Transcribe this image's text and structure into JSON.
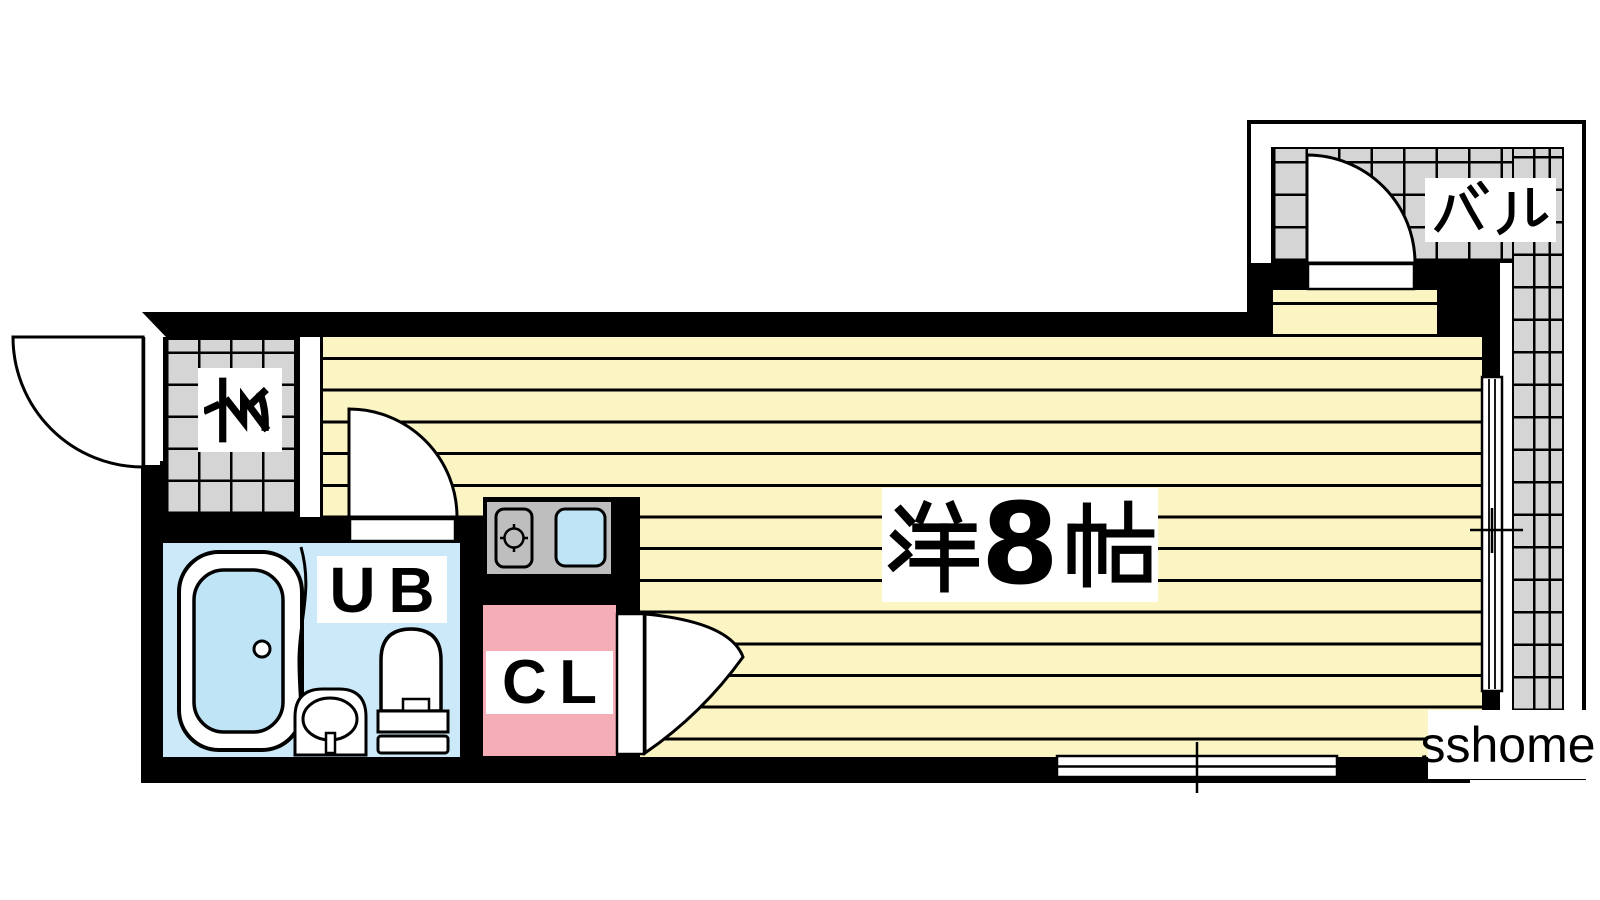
{
  "rooms": {
    "entrance": {
      "label": "玄"
    },
    "main_room": {
      "label": "洋8帖"
    },
    "unit_bath": {
      "label": "UB"
    },
    "closet": {
      "label": "CL"
    },
    "balcony": {
      "label": "バル"
    }
  },
  "watermark": "sshome",
  "colors": {
    "wall": "#000000",
    "room_floor": "#FBF5C4",
    "tile_floor": "#D5D5D5",
    "bath_floor": "#CBE9F8",
    "fixture_water": "#BFE4F6",
    "closet_floor": "#F5AEB6",
    "counter": "#BEBEBE"
  }
}
